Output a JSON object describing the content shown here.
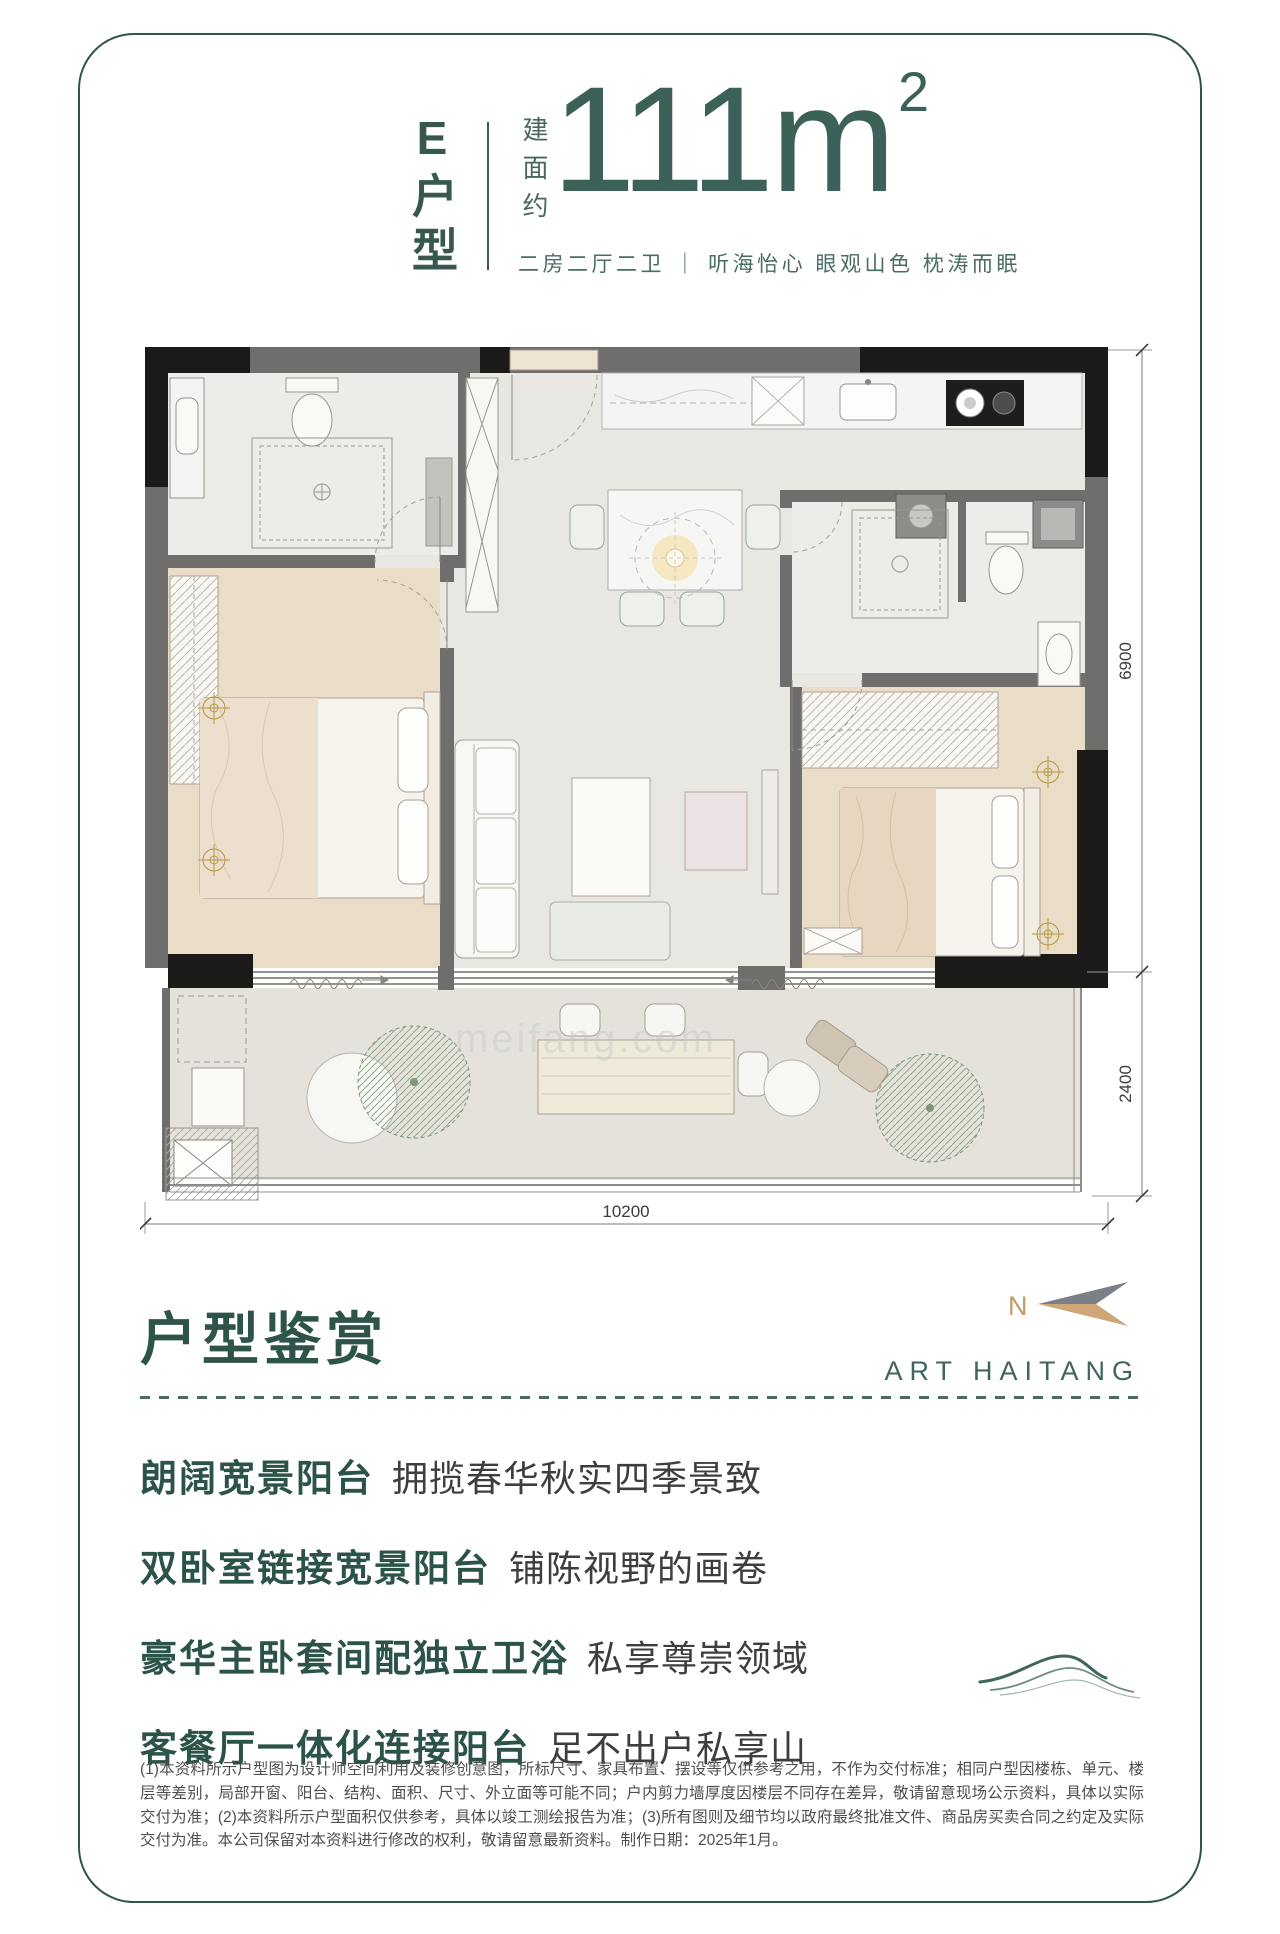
{
  "header": {
    "plan_letter": "E户型",
    "area_prefix": "建面约",
    "area_value": "111m",
    "area_sup": "2",
    "tagline": "二房二厅二卫 ｜ 听海怡心 眼观山色 枕涛而眠"
  },
  "plan": {
    "dims": {
      "right_upper": "6900",
      "right_lower": "2400",
      "bottom": "10200"
    },
    "north_label": "N",
    "watermark": "meifang.com"
  },
  "section": {
    "title": "户型鉴赏",
    "brand": "ART HAITANG",
    "features": [
      {
        "head": "朗阔宽景阳台",
        "desc": "拥揽春华秋实四季景致"
      },
      {
        "head": "双卧室链接宽景阳台",
        "desc": "铺陈视野的画卷"
      },
      {
        "head": "豪华主卧套间配独立卫浴",
        "desc": "私享尊崇领域"
      },
      {
        "head": "客餐厅一体化连接阳台",
        "desc": "足不出户私享山"
      }
    ]
  },
  "disclaimer": {
    "text": "(1)本资料所示户型图为设计师空间利用及装修创意图，所标尺寸、家具布置、摆设等仅供参考之用，不作为交付标准；相同户型因楼栋、单元、楼层等差别，局部开窗、阳台、结构、面积、尺寸、外立面等可能不同；户内剪力墙厚度因楼层不同存在差异，敬请留意现场公示资料，具体以实际交付为准；(2)本资料所示户型面积仅供参考，具体以竣工测绘报告为准；(3)所有图则及细节均以政府最终批准文件、商品房买卖合同之约定及实际交付为准。本公司保留对本资料进行修改的权利，敬请留意最新资料。制作日期：2025年1月。"
  }
}
